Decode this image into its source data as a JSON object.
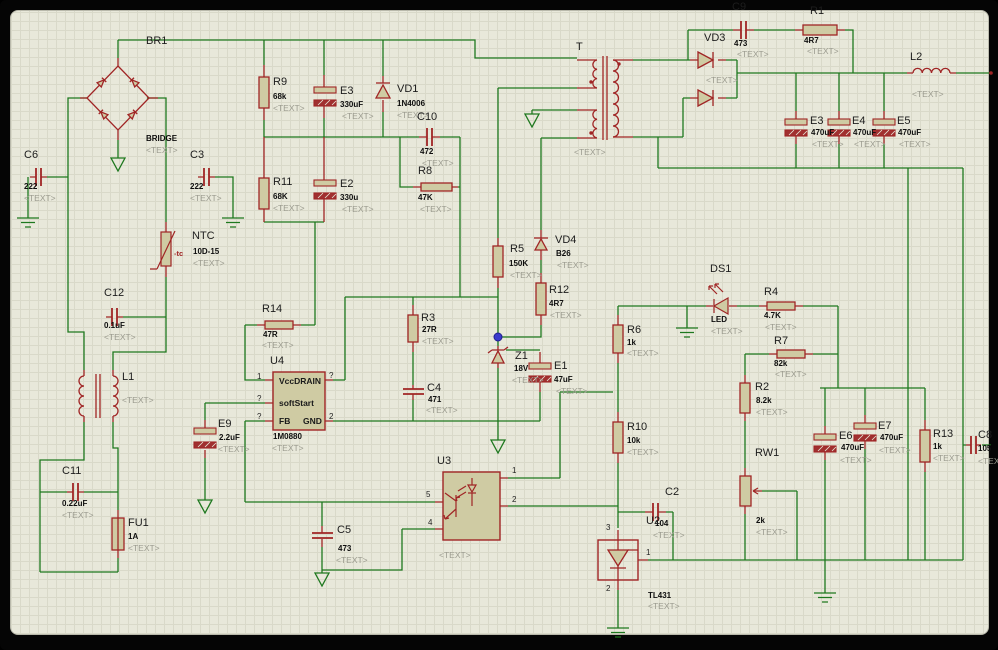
{
  "placeholder": "<TEXT>",
  "components": {
    "BR1": {
      "ref": "BR1",
      "value": "BRIDGE"
    },
    "C6": {
      "ref": "C6",
      "value": "222"
    },
    "C3": {
      "ref": "C3",
      "value": "222"
    },
    "NTC": {
      "ref": "NTC",
      "value": "10D-15",
      "tc": "-tc"
    },
    "C12": {
      "ref": "C12",
      "value": "0.1uF"
    },
    "L1": {
      "ref": "L1"
    },
    "C11": {
      "ref": "C11",
      "value": "0.22uF"
    },
    "FU1": {
      "ref": "FU1",
      "value": "1A"
    },
    "R9": {
      "ref": "R9",
      "value": "68k"
    },
    "E3A": {
      "ref": "E3",
      "value": "330uF"
    },
    "R11": {
      "ref": "R11",
      "value": "68K"
    },
    "E2": {
      "ref": "E2",
      "value": "330u"
    },
    "VD1": {
      "ref": "VD1",
      "value": "1N4006"
    },
    "C10": {
      "ref": "C10",
      "value": "472"
    },
    "R8": {
      "ref": "R8",
      "value": "47K"
    },
    "T": {
      "ref": "T"
    },
    "VD3": {
      "ref": "VD3"
    },
    "C9": {
      "ref": "C9",
      "value": "473"
    },
    "R1": {
      "ref": "R1",
      "value": "4R7"
    },
    "L2": {
      "ref": "L2"
    },
    "E3B": {
      "ref": "E3",
      "value": "470uF"
    },
    "E4": {
      "ref": "E4",
      "value": "470uF"
    },
    "E5": {
      "ref": "E5",
      "value": "470uF"
    },
    "R5": {
      "ref": "R5",
      "value": "150K"
    },
    "VD4": {
      "ref": "VD4",
      "value": "B26"
    },
    "R12": {
      "ref": "R12",
      "value": "4R7"
    },
    "R6": {
      "ref": "R6",
      "value": "1k"
    },
    "R10": {
      "ref": "R10",
      "value": "10k"
    },
    "DS1": {
      "ref": "DS1",
      "value": "LED"
    },
    "R4": {
      "ref": "R4",
      "value": "4.7K"
    },
    "R7": {
      "ref": "R7",
      "value": "82k"
    },
    "R2": {
      "ref": "R2",
      "value": "8.2k"
    },
    "RW1": {
      "ref": "RW1",
      "value": "2k"
    },
    "E6": {
      "ref": "E6",
      "value": "470uF"
    },
    "E7": {
      "ref": "E7",
      "value": "470uF"
    },
    "R13": {
      "ref": "R13",
      "value": "1k"
    },
    "C8": {
      "ref": "C8",
      "value": "105"
    },
    "R14": {
      "ref": "R14",
      "value": "47R"
    },
    "R3": {
      "ref": "R3",
      "value": "27R"
    },
    "C4": {
      "ref": "C4",
      "value": "471"
    },
    "E9": {
      "ref": "E9",
      "value": "2.2uF"
    },
    "Z1": {
      "ref": "Z1",
      "value": "18V"
    },
    "E1": {
      "ref": "E1",
      "value": "47uF"
    },
    "C5": {
      "ref": "C5",
      "value": "473"
    },
    "C2": {
      "ref": "C2",
      "value": "104"
    },
    "U2": {
      "ref": "U2",
      "value": "TL431",
      "pins": {
        "p1": "1",
        "p2": "2",
        "p3": "3"
      }
    },
    "U3": {
      "ref": "U3",
      "pins": {
        "p1": "1",
        "p2": "2",
        "p4": "4",
        "p5": "5"
      }
    },
    "U4": {
      "ref": "U4",
      "value": "1M0880",
      "pins": {
        "l1": "1",
        "l2": "?",
        "l3": "?",
        "r1": "?",
        "r2": "2"
      },
      "labels": {
        "vccdrain": "VccDRAIN",
        "soft": "softStart",
        "fb": "FB",
        "gnd": "GND"
      }
    }
  }
}
